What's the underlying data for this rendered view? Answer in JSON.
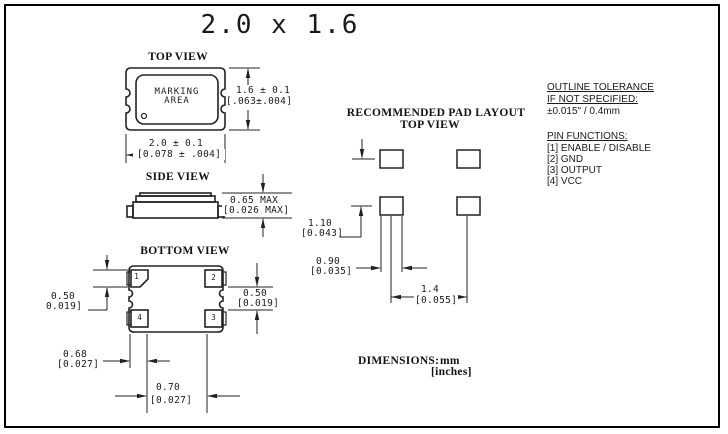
{
  "title": "2.0 x 1.6",
  "top_view": {
    "label": "TOP VIEW",
    "marking": "MARKING\nAREA",
    "height_mm": "1.6 ± 0.1",
    "height_in": "[.063±.004]",
    "width_mm": "2.0 ± 0.1",
    "width_in": "[0.078 ± .004]"
  },
  "side_view": {
    "label": "SIDE VIEW",
    "height_mm": "0.65 MAX",
    "height_in": "[0.026 MAX]"
  },
  "bottom_view": {
    "label": "BOTTOM VIEW",
    "pad_numbers": [
      "1",
      "2",
      "3",
      "4"
    ],
    "pad_height_mm": "0.50",
    "pad_height_in": "0.019]",
    "pad_gap_mm": "0.50",
    "pad_gap_in": "[0.019]",
    "corner_offset_mm": "0.68",
    "corner_offset_in": "[0.027]",
    "pad_span_mm": "0.70",
    "pad_span_in": "[0.027]"
  },
  "pad_layout": {
    "title": "RECOMMENDED PAD LAYOUT",
    "subtitle": "TOP VIEW",
    "row_pitch_mm": "1.10",
    "row_pitch_in": "[0.043]",
    "pad_width_mm": "0.90",
    "pad_width_in": "[0.035]",
    "col_pitch_mm": "1.4",
    "col_pitch_in": "[0.055]"
  },
  "notes": {
    "tolerance_title": "OUTLINE TOLERANCE",
    "tolerance_condition": "IF NOT SPECIFIED:",
    "tolerance_value": "±0.015\" / 0.4mm",
    "pin_functions_title": "PIN FUNCTIONS:",
    "pin_functions": [
      "[1] ENABLE / DISABLE",
      "[2] GND",
      "[3] OUTPUT",
      "[4] VCC"
    ]
  },
  "footer": {
    "dimensions_label": "DIMENSIONS:",
    "unit_primary": "mm",
    "unit_secondary": "[inches]"
  }
}
